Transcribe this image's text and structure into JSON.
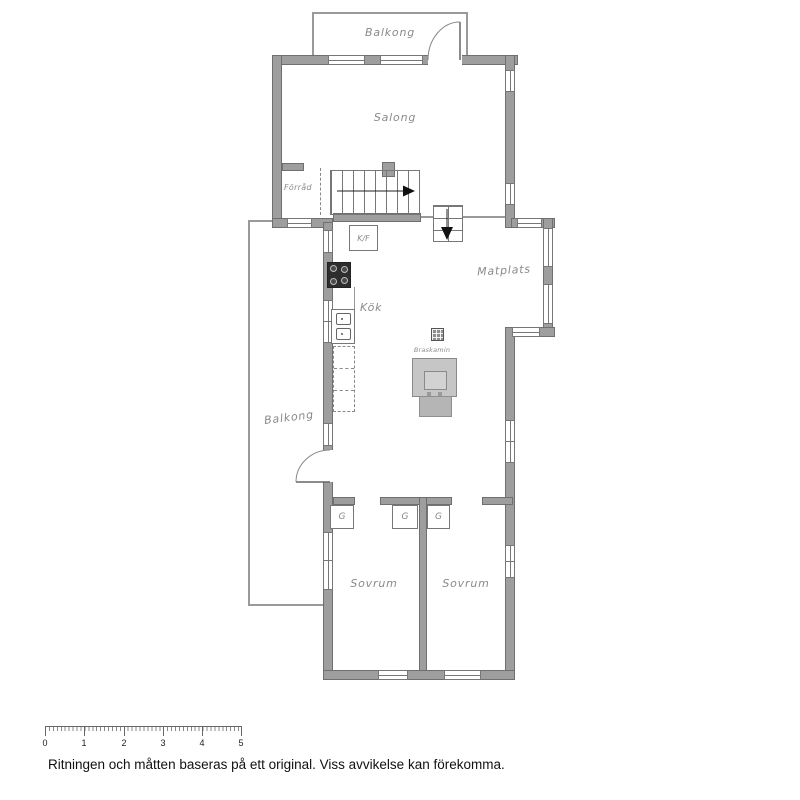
{
  "plan": {
    "rooms": {
      "balkong_top": "Balkong",
      "salong": "Salong",
      "forrad": "Förråd",
      "kf": "K/F",
      "kok": "Kök",
      "matplats": "Matplats",
      "braskamin": "Braskamin",
      "balkong_left": "Balkong",
      "sovrum_left": "Sovrum",
      "sovrum_right": "Sovrum",
      "g1": "G",
      "g2": "G",
      "g3": "G"
    },
    "colors": {
      "wall": "#9e9e9e",
      "wall_edge": "#6f6f6f",
      "fixture_fill": "#c6c6c6",
      "label": "#8a8a8a"
    }
  },
  "scale_bar": {
    "labels": [
      "0",
      "1",
      "2",
      "3",
      "4",
      "5"
    ]
  },
  "footer": {
    "disclaimer": "Ritningen och måtten baseras på ett original. Viss avvikelse kan förekomma."
  }
}
